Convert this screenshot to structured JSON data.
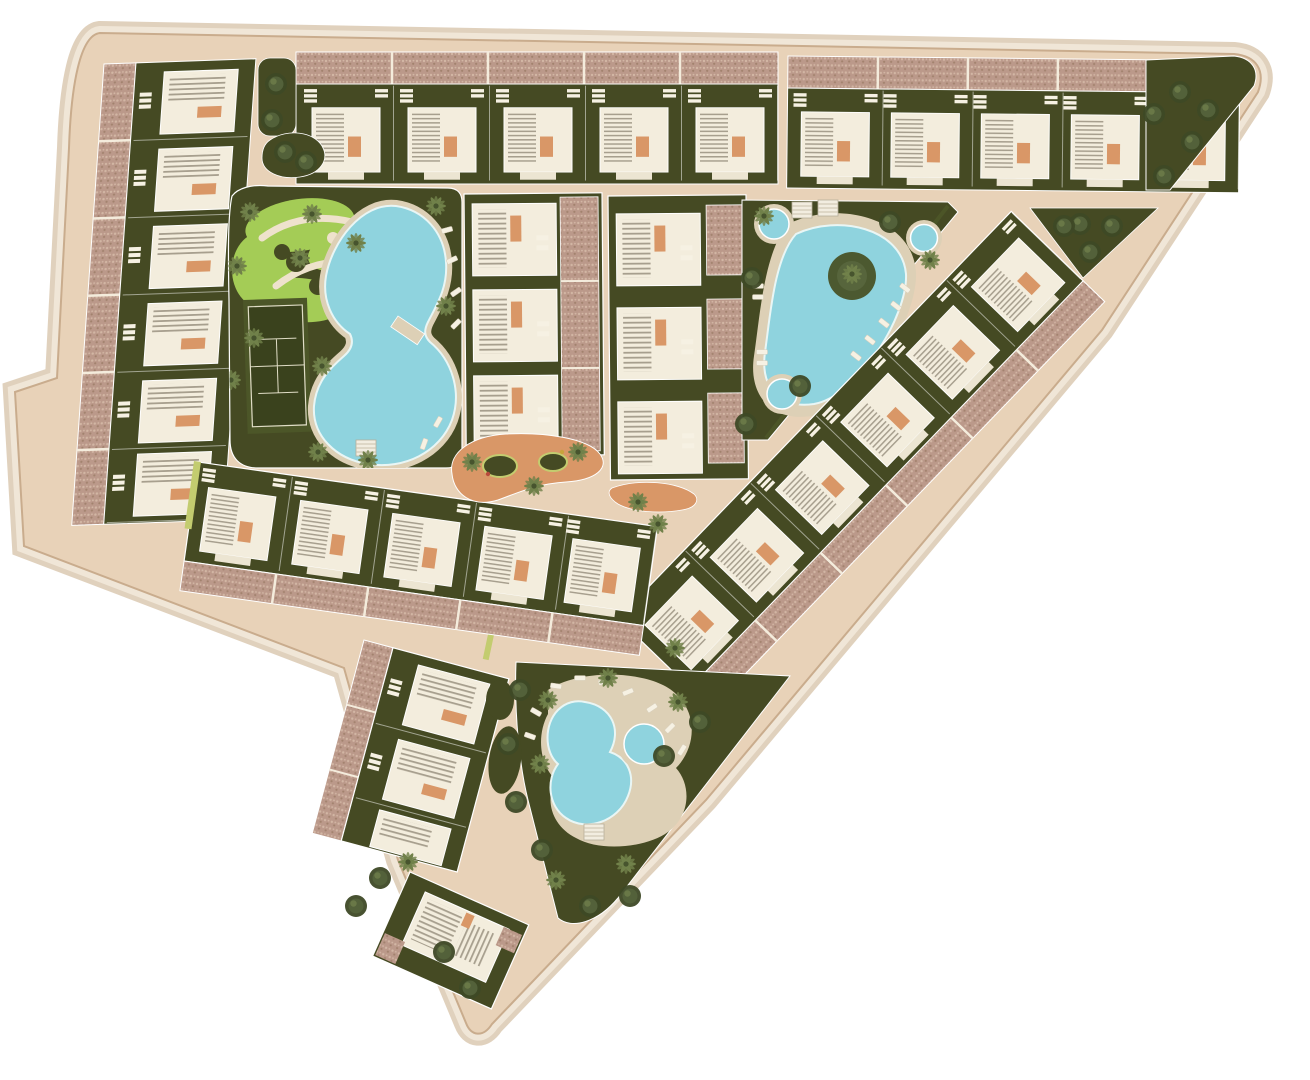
{
  "site_plan": {
    "type": "aerial-masterplan-render",
    "description": "Top-down 3D render of a triangular residential resort community with townhouse rows, communal pools, gardens and a tennis court",
    "palette": {
      "background": "#ffffff",
      "halo_outer": "#d8c5ac",
      "halo_inner": "#f0e6d7",
      "road": "#e8d2b8",
      "road_edge": "#c9ac8d",
      "garden": "#454a23",
      "lawn": "#a4cc56",
      "water": "#8fd3de",
      "water_rim": "#e9f6f5",
      "deck": "#ddd0b6",
      "building": "#f3eddd",
      "roof_terrace": "#bb998a",
      "roof_speckle_light": "#d2b6a4",
      "roof_speckle_dark": "#a2826e",
      "terracotta": "#d99767",
      "court": "#3a421d",
      "court_line": "#e0ddc6",
      "path": "#eee2cc",
      "hedge": "#c3cc6f",
      "tree": "#53613a",
      "palm": "#71814a",
      "stair_tread": "#a79f8e",
      "furniture": "#f6f1e3"
    },
    "zones": [
      {
        "id": "northwest-townhouse-row",
        "kind": "townhouse-row",
        "units": 5
      },
      {
        "id": "northeast-townhouse-row",
        "kind": "townhouse-row",
        "units": 5
      },
      {
        "id": "west-townhouse-column",
        "kind": "townhouse-row",
        "units": 6
      },
      {
        "id": "central-park",
        "kind": "amenity-garden",
        "features": [
          "ornamental-lawn",
          "tennis-court",
          "lagoon-pool",
          "footbridge",
          "sun-loungers",
          "palm-trees",
          "pergola"
        ]
      },
      {
        "id": "central-block-west",
        "kind": "apartment-block",
        "units": 3
      },
      {
        "id": "central-block-east",
        "kind": "apartment-block",
        "units": 3
      },
      {
        "id": "east-pool-garden",
        "kind": "amenity-garden",
        "features": [
          "teardrop-pool",
          "planted-island",
          "round-plunge-pools",
          "pergolas",
          "sun-loungers"
        ]
      },
      {
        "id": "southeast-diagonal-row",
        "kind": "townhouse-row",
        "units": 6
      },
      {
        "id": "mid-townhouse-row",
        "kind": "townhouse-row",
        "units": 5
      },
      {
        "id": "children-playground",
        "kind": "play-area",
        "surface": "terracotta-sand"
      },
      {
        "id": "south-block",
        "kind": "apartment-block",
        "units": 3
      },
      {
        "id": "south-pool-garden",
        "kind": "amenity-garden",
        "features": [
          "twin-lobe-pool",
          "round-pool",
          "pergola",
          "palm-grove",
          "sun-loungers"
        ]
      },
      {
        "id": "south-tip-block",
        "kind": "apartment-block",
        "units": 1
      },
      {
        "id": "northwest-traffic-island",
        "kind": "landscaped-island"
      }
    ],
    "counts": {
      "tennis_courts": 1,
      "large_pools": 3,
      "small_round_pools": 4,
      "townhouse_rows": 6,
      "apartment_blocks": 7
    }
  }
}
